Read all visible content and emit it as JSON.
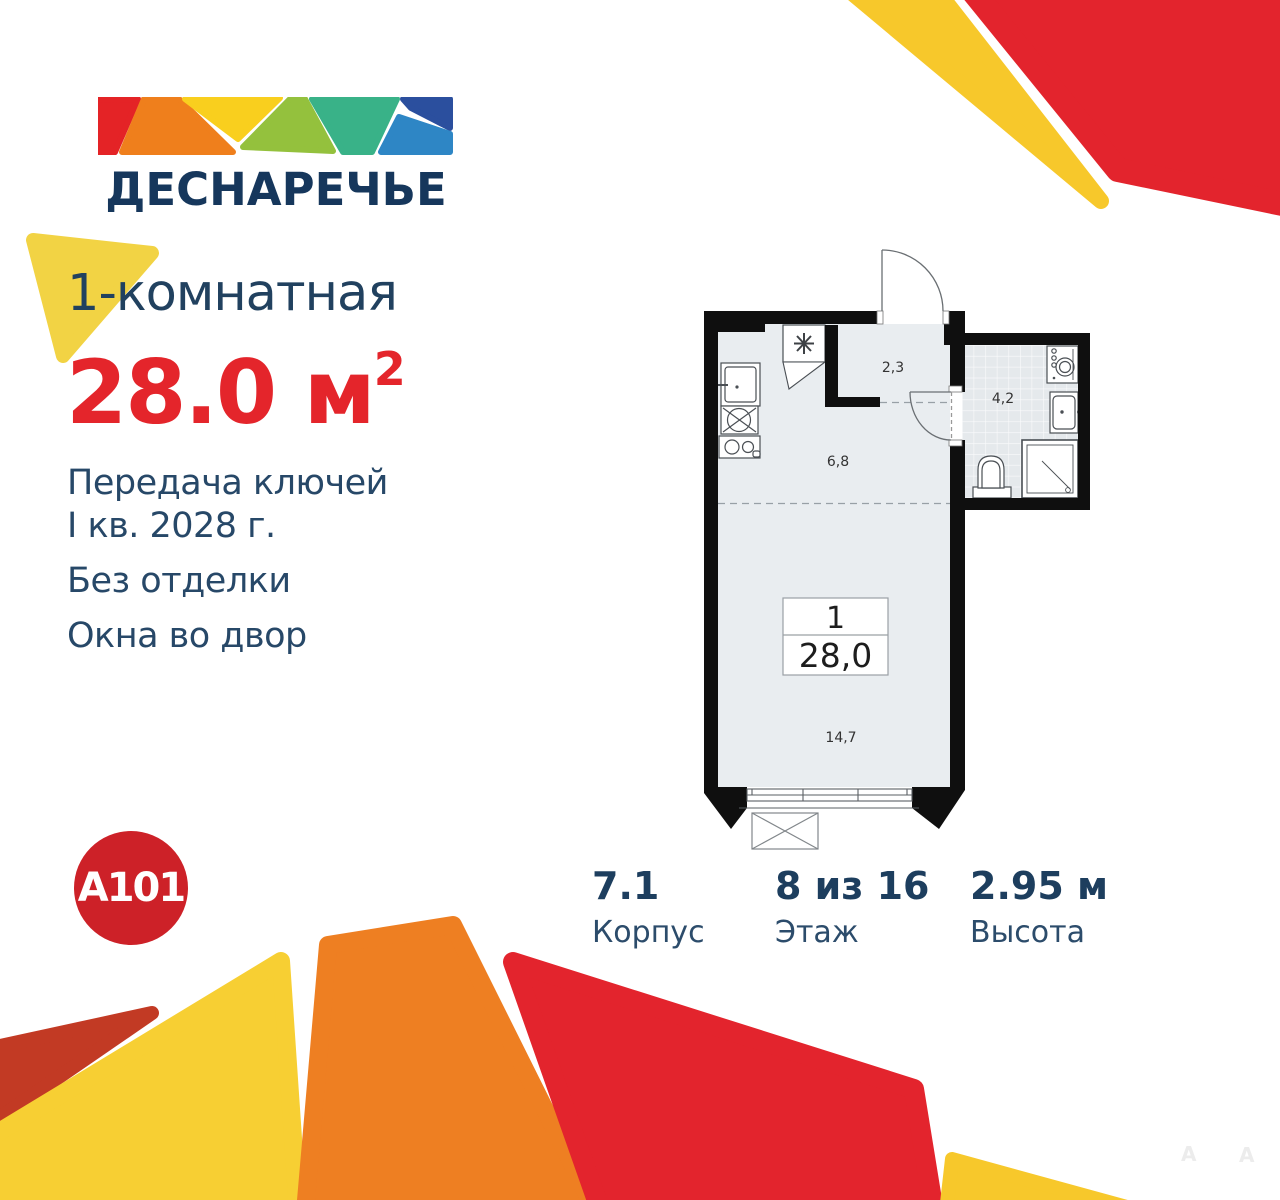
{
  "brand": {
    "complex_name": "ДЕСНАРЕЧЬЕ",
    "developer_name": "A101"
  },
  "listing": {
    "rooms_title": "1-комнатная",
    "area_value": "28.0",
    "area_unit": "м",
    "area_power": "2",
    "handover_line1": "Передача ключей",
    "handover_line2": "I кв. 2028 г.",
    "finish": "Без отделки",
    "windows_view": "Окна во двор"
  },
  "stats": [
    {
      "value": "7.1",
      "label": "Корпус"
    },
    {
      "value": "8 из 16",
      "label": "Этаж"
    },
    {
      "value": "2.95 м",
      "label": "Высота"
    }
  ],
  "floor_plan": {
    "hallway_area": "2,3",
    "bathroom_area": "4,2",
    "kitchen_area": "6,8",
    "room_area": "14,7",
    "unit_box": {
      "rooms_count": "1",
      "total_area": "28,0"
    }
  },
  "watermark": {
    "letters": [
      "A",
      "A"
    ]
  },
  "colors": {
    "navy_text": "#21415f",
    "accent_red": "#e4252b",
    "decor_red": "#e3242d",
    "decor_dark_red": "#c23a24",
    "decor_orange": "#ee7f22",
    "decor_yellow": "#f7c82b",
    "decor_pale_yellow": "#f2d344",
    "a101_red": "#cd2128",
    "logo_mosaic": [
      "#e42326",
      "#ef7f1c",
      "#f9cf1e",
      "#94c13d",
      "#39b288",
      "#2b4f9e",
      "#2e86c5"
    ],
    "plan_wall": "#0f0f0f",
    "plan_floor": "#e9edf0"
  }
}
